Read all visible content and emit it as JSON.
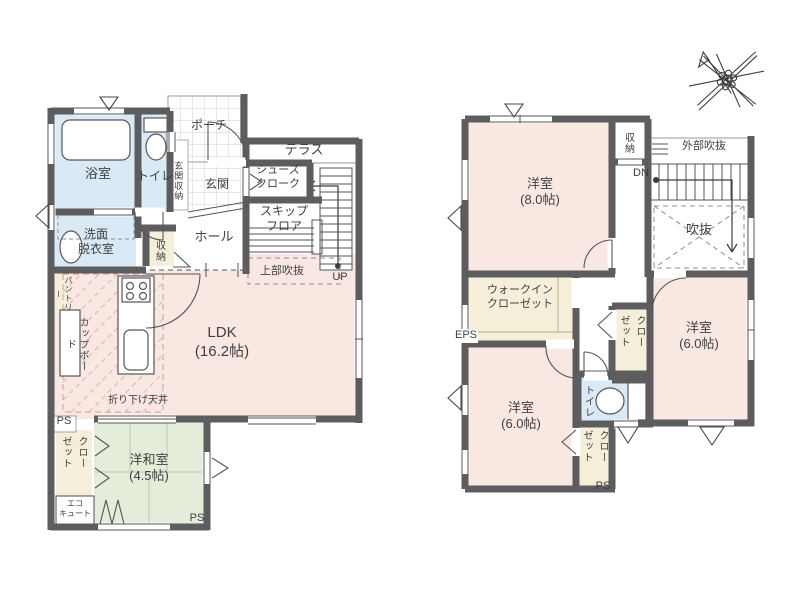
{
  "colors": {
    "wall": "#5d5d60",
    "pink": "#f9e7e1",
    "green": "#e3edd9",
    "blue": "#d9e9f5",
    "beige": "#f5eed8",
    "line": "#565656",
    "text": "#3f3f42",
    "hatch": "#e0b2a9"
  },
  "floor1": {
    "bath": "浴室",
    "toilet": "トイレ",
    "genkan_storage": "玄関収納",
    "porch": "ポーチ",
    "terrace": "テラス",
    "genkan": "玄関",
    "shoes_1": "シューズ",
    "shoes_2": "クローク",
    "wash_1": "洗面",
    "wash_2": "脱衣室",
    "hall": "ホール",
    "storage": "収納",
    "skip_1": "スキップ",
    "skip_2": "フロア",
    "upper_void": "上部吹抜",
    "up": "UP",
    "ldk_1": "LDK",
    "ldk_2": "(16.2帖)",
    "pantry": "パントリー",
    "cupboard": "カップボード",
    "dropped_ceiling": "折り下げ天井",
    "ps_left": "PS",
    "ps_bottom": "PS",
    "closet_a": "クロー",
    "closet_b": "ゼット",
    "jp_room_1": "洋和室",
    "jp_room_2": "(4.5帖)",
    "eco_1": "エコ",
    "eco_2": "キュート"
  },
  "floor2": {
    "room8_1": "洋室",
    "room8_2": "(8.0帖)",
    "storage": "収納",
    "outer_void": "外部吹抜",
    "dn": "DN",
    "void": "吹抜",
    "wic_1": "ウォークイン",
    "wic_2": "クローゼット",
    "eps": "EPS",
    "closet_mid_a": "クロー",
    "closet_mid_b": "ゼット",
    "room6r_1": "洋室",
    "room6r_2": "(6.0帖)",
    "toilet": "トイレ",
    "room6l_1": "洋室",
    "room6l_2": "(6.0帖)",
    "closet_btm_a": "クロー",
    "closet_btm_b": "ゼット",
    "ps": "PS"
  }
}
